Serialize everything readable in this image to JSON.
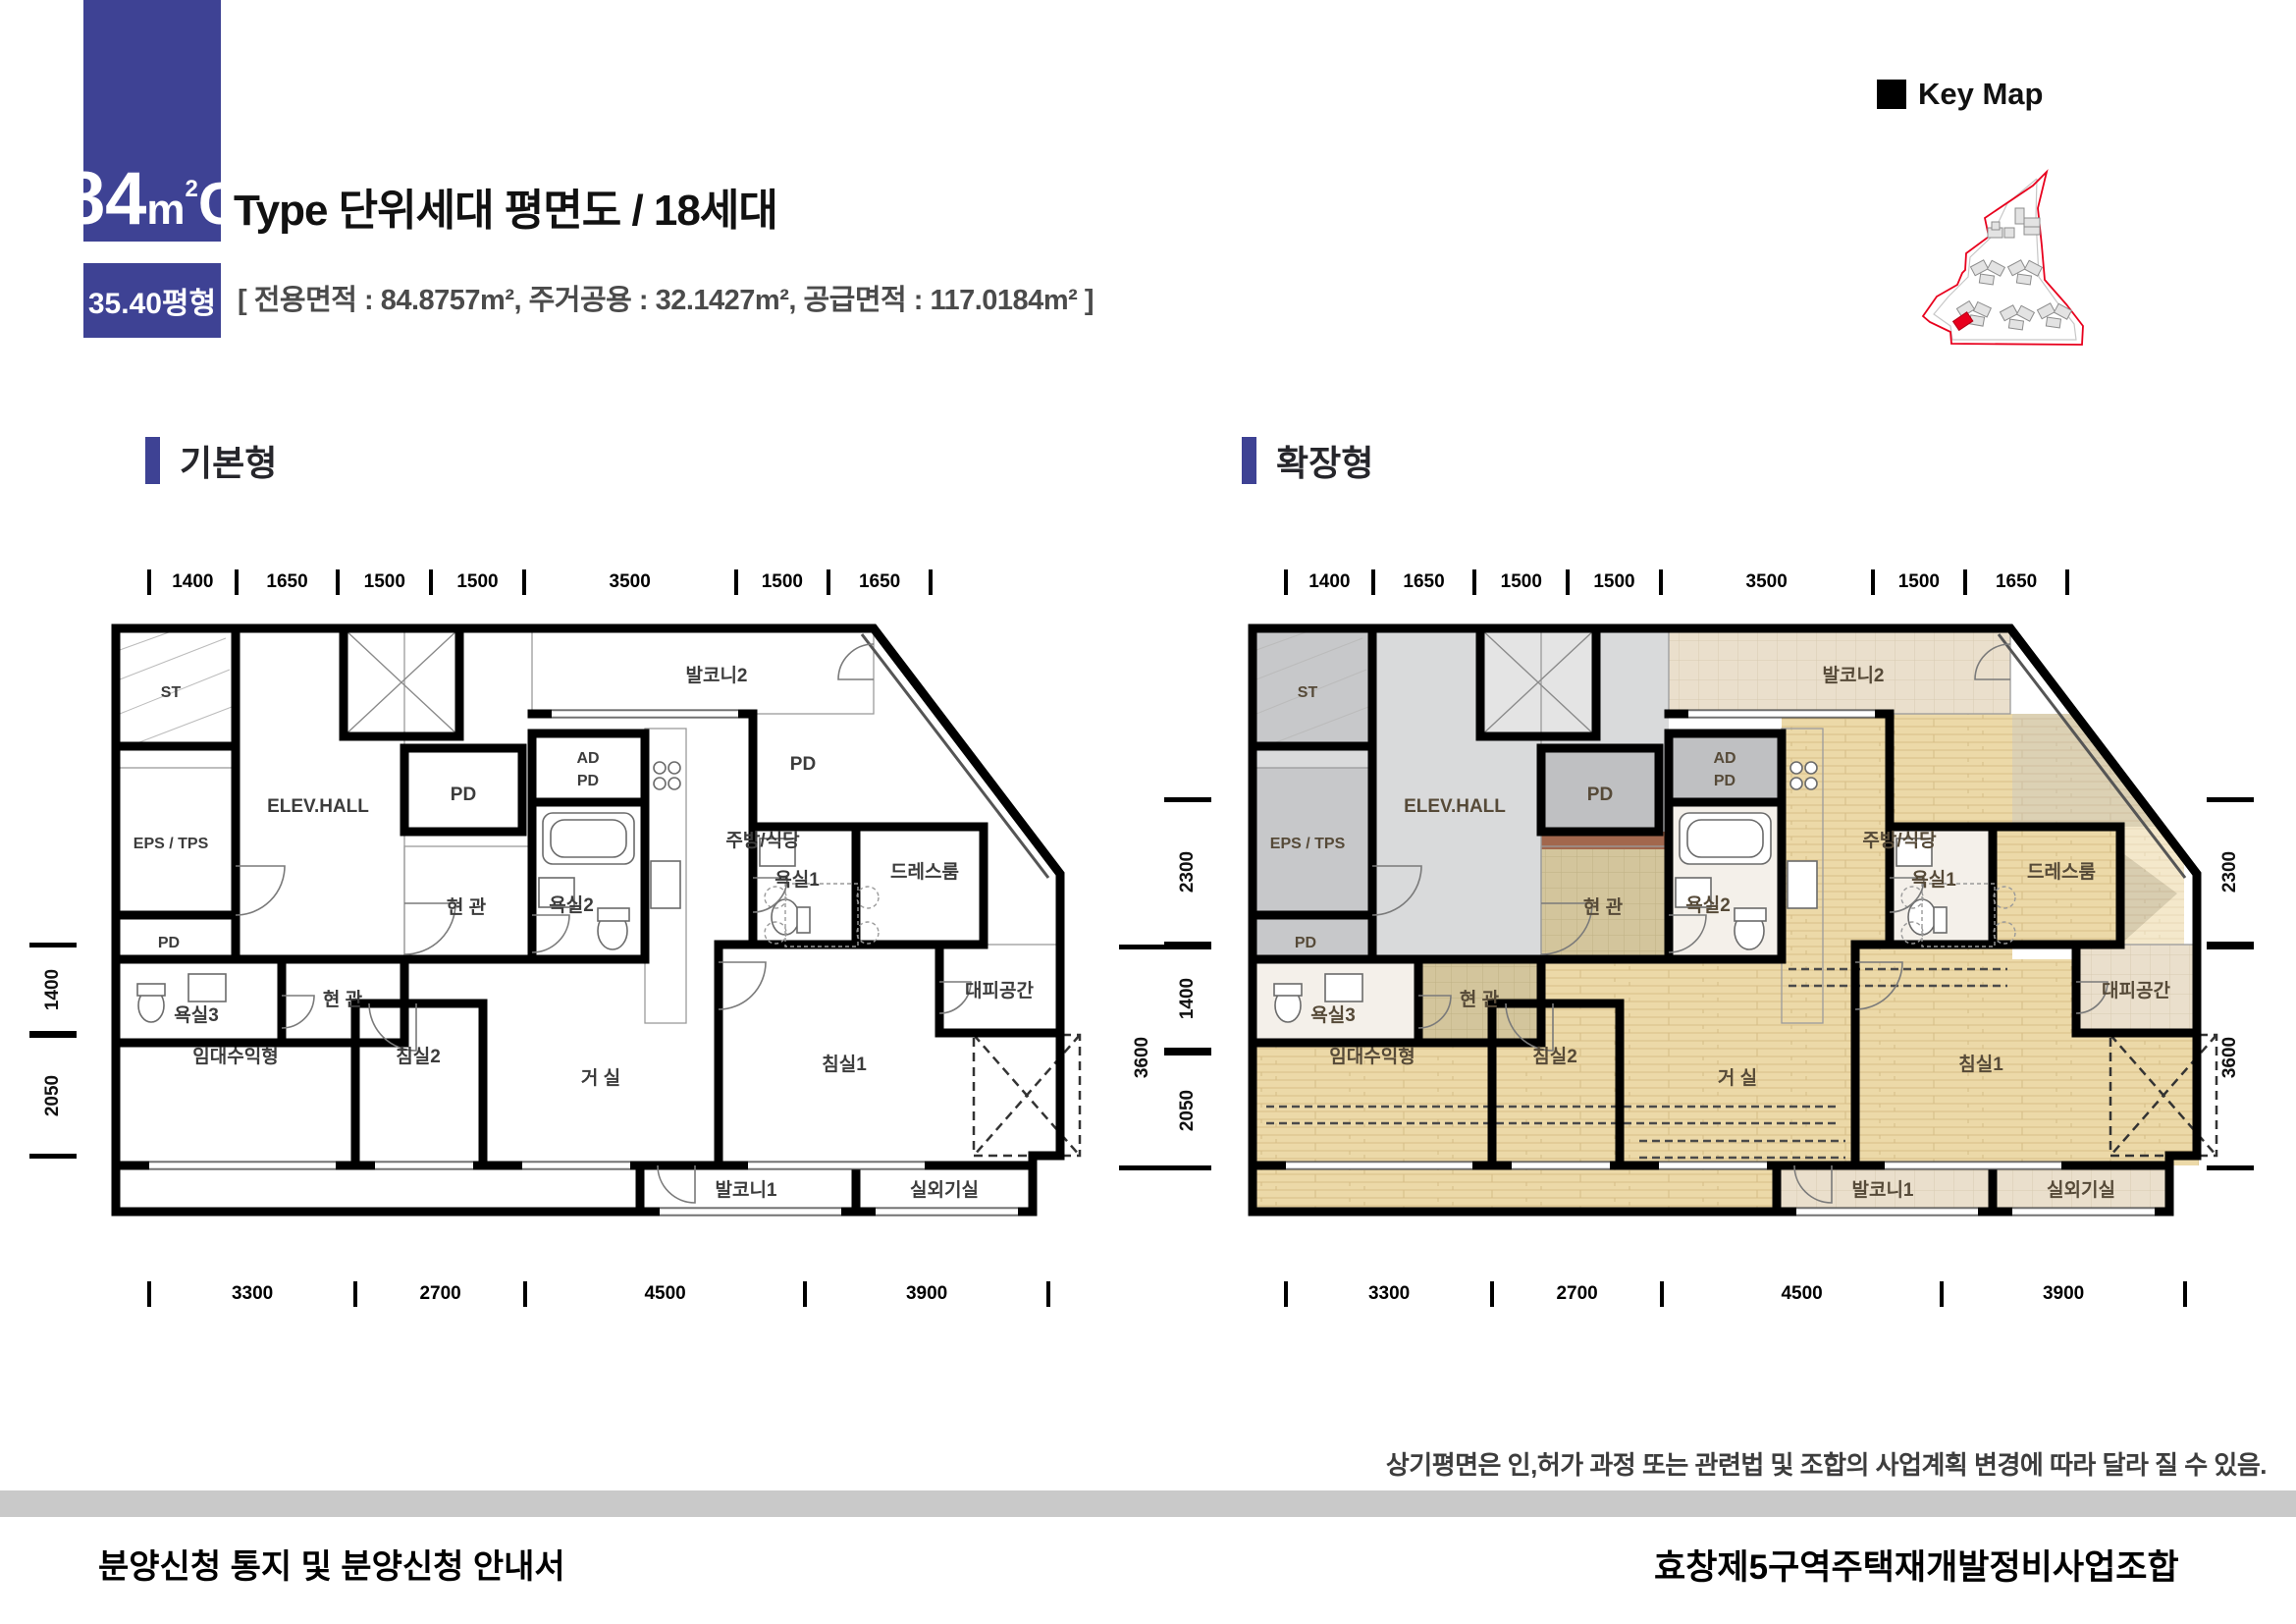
{
  "header": {
    "type_number": "84",
    "type_unit": "m",
    "type_sup": "2",
    "type_letter": "C",
    "title_rest": "Type 단위세대 평면도 / 18세대",
    "pyeong": "35.40평형",
    "area_info": "[ 전용면적 : 84.8757m², 주거공용 : 32.1427m², 공급면적 : 117.0184m² ]"
  },
  "keymap": {
    "label": "Key Map"
  },
  "sections": {
    "basic": "기본형",
    "extended": "확장형"
  },
  "dims": {
    "top": [
      "1400",
      "1650",
      "1500",
      "1500",
      "3500",
      "1500",
      "1650"
    ],
    "bottom": [
      "3300",
      "2700",
      "4500",
      "3900"
    ],
    "left": [
      "1400",
      "2050"
    ],
    "right_basic": [
      "2300",
      "1400",
      "2050",
      "3600"
    ],
    "right_extended": [
      "2300",
      "3600"
    ]
  },
  "rooms": {
    "st": "ST",
    "elev_hall": "ELEV.HALL",
    "pd": "PD",
    "ad": "AD",
    "eps_tps": "EPS / TPS",
    "entry": "현 관",
    "bath1": "욕실1",
    "bath2": "욕실2",
    "bath3": "욕실3",
    "dress": "드레스룸",
    "balcony1": "발코니1",
    "balcony2": "발코니2",
    "kitchen": "주방/식당",
    "living": "거 실",
    "bed1": "침실1",
    "bed2": "침실2",
    "rental": "임대수익형",
    "evac": "대피공간",
    "outdoor": "실외기실"
  },
  "note": "상기평면은 인,허가 과정 또는 관련법 및 조합의 사업계획 변경에 따라 달라 질 수 있음.",
  "footer": {
    "left": "분양신청 통지 및 분양신청 안내서",
    "right": "효창제5구역주택재개발정비사업조합"
  }
}
